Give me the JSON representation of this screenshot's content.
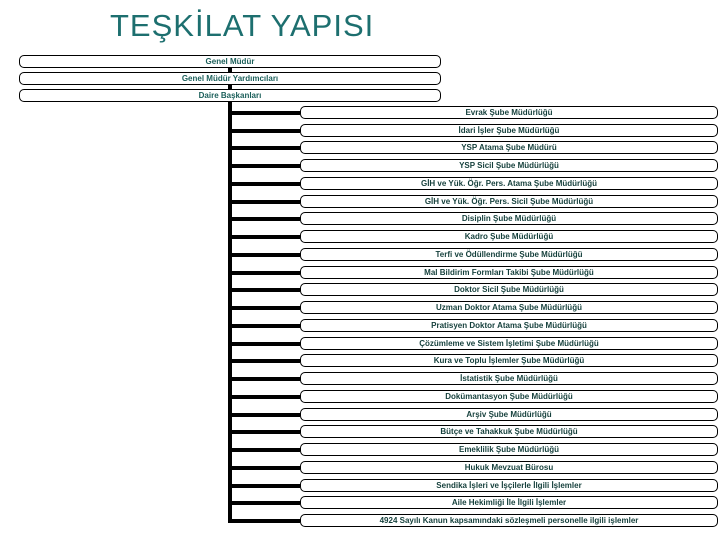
{
  "slide": {
    "title": "TEŞKİLAT YAPISI"
  },
  "hierarchy": {
    "levels": [
      {
        "label": "Genel Müdür"
      },
      {
        "label": "Genel Müdür Yardımcıları"
      },
      {
        "label": "Daire Başkanları"
      }
    ],
    "units": [
      "Evrak Şube Müdürlüğü",
      "İdari İşler Şube Müdürlüğü",
      "YSP Atama Şube Müdürü",
      "YSP Sicil Şube Müdürlüğü",
      "GİH ve Yük. Öğr. Pers. Atama Şube Müdürlüğü",
      "GİH ve Yük. Öğr. Pers. Sicil Şube Müdürlüğü",
      "Disiplin Şube Müdürlüğü",
      "Kadro Şube Müdürlüğü",
      "Terfi ve Ödüllendirme Şube Müdürlüğü",
      "Mal Bildirim Formları Takibi Şube Müdürlüğü",
      "Doktor Sicil Şube Müdürlüğü",
      "Uzman Doktor Atama Şube Müdürlüğü",
      "Pratisyen Doktor Atama Şube Müdürlüğü",
      "Çözümleme ve Sistem İşletimi Şube Müdürlüğü",
      "Kura ve Toplu İşlemler Şube Müdürlüğü",
      "İstatistik Şube Müdürlüğü",
      "Dokümantasyon Şube Müdürlüğü",
      "Arşiv Şube Müdürlüğü",
      "Bütçe ve Tahakkuk Şube Müdürlüğü",
      "Emeklilik Şube Müdürlüğü",
      "Hukuk Mevzuat Bürosu",
      "Sendika İşleri ve İşçilerle İlgili İşlemler",
      "Aile Hekimliği İle İlgili İşlemler",
      "4924 Sayılı Kanun kapsamındaki sözleşmeli personelle ilgili işlemler"
    ]
  },
  "colors": {
    "title_text": "#1d6f6f",
    "level_text": "#1b5f5a",
    "unit_text": "#143f3b",
    "connector": "#000000",
    "box_border": "#000000",
    "background": "#ffffff"
  }
}
